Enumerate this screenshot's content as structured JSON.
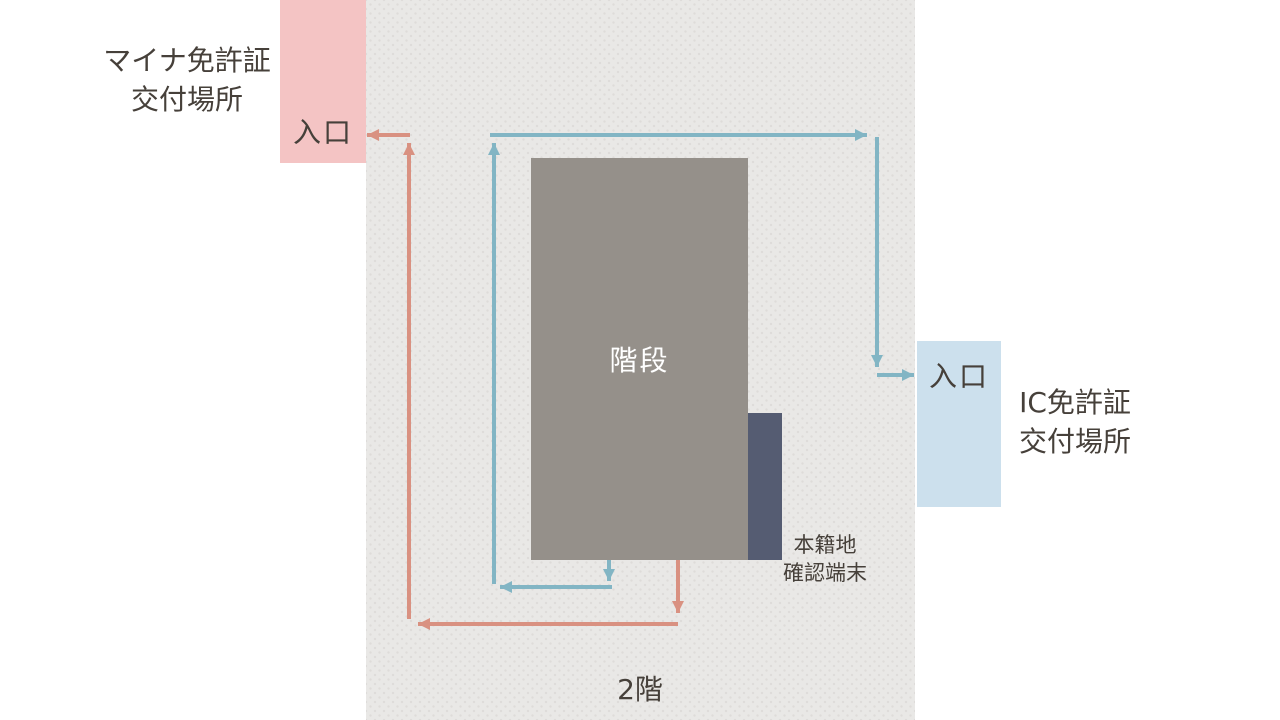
{
  "title": "2階 交付場所 案内図",
  "labels": {
    "myna_location_line1": "マイナ免許証",
    "myna_location_line2": "交付場所",
    "entrance_left": "入口",
    "entrance_right": "入口",
    "ic_location_line1": "IC免許証",
    "ic_location_line2": "交付場所",
    "stairs": "階段",
    "terminal_line1": "本籍地",
    "terminal_line2": "確認端末",
    "floor": "2階"
  },
  "colors": {
    "background": "#ffffff",
    "floor": "#e9e8e6",
    "floor_dot": "#dedcd9",
    "entrance_pink": "#f4c4c4",
    "entrance_blue": "#cce0ed",
    "stairs": "#95908a",
    "terminal": "#555c72",
    "arrow_pink": "#d99181",
    "arrow_blue": "#82b5c4",
    "text": "#46403a",
    "stairs_text": "#ffffff"
  },
  "routes": [
    {
      "id": "myna-entrance-route",
      "color_key": "arrow_pink",
      "segments": [
        {
          "x1": 678,
          "y1": 560,
          "x2": 678,
          "y2": 613
        },
        {
          "x1": 678,
          "y1": 624,
          "x2": 418,
          "y2": 624
        },
        {
          "x1": 409,
          "y1": 619,
          "x2": 409,
          "y2": 143
        },
        {
          "x1": 410,
          "y1": 135,
          "x2": 367,
          "y2": 135
        }
      ]
    },
    {
      "id": "ic-entrance-route",
      "color_key": "arrow_blue",
      "segments": [
        {
          "x1": 609,
          "y1": 560,
          "x2": 609,
          "y2": 581
        },
        {
          "x1": 612,
          "y1": 587,
          "x2": 500,
          "y2": 587
        },
        {
          "x1": 494,
          "y1": 584,
          "x2": 494,
          "y2": 143
        },
        {
          "x1": 490,
          "y1": 135,
          "x2": 867,
          "y2": 135
        },
        {
          "x1": 877,
          "y1": 137,
          "x2": 877,
          "y2": 367
        },
        {
          "x1": 877,
          "y1": 375,
          "x2": 914,
          "y2": 375
        }
      ]
    }
  ],
  "arrow_style": {
    "stroke_width": 4,
    "head_length": 3,
    "head_width": 3
  }
}
